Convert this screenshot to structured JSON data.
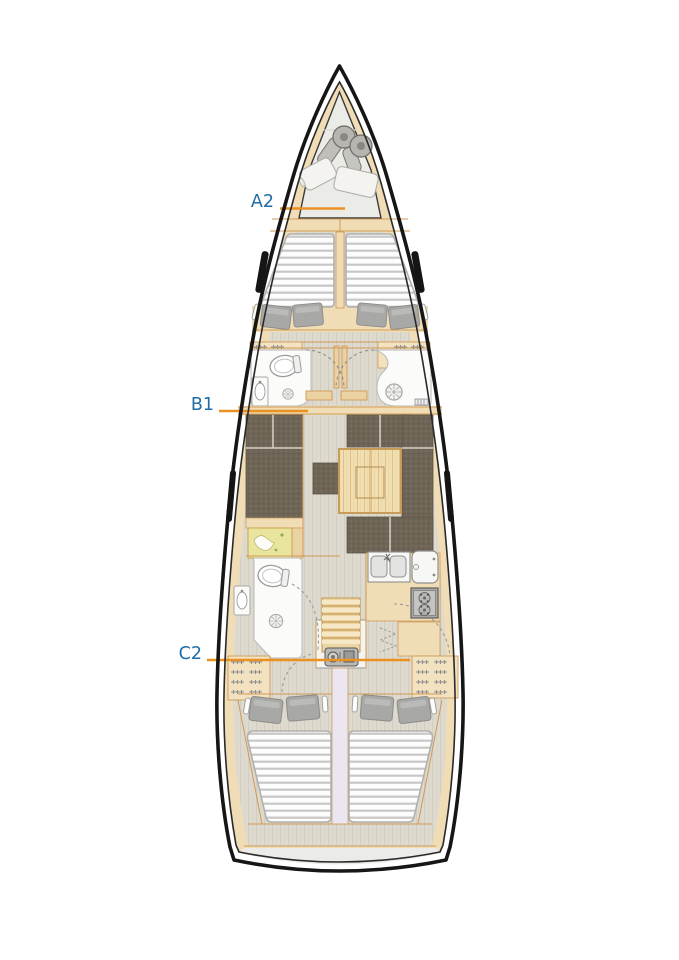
{
  "page": {
    "background": "#ffffff"
  },
  "diagram": {
    "title": "sailing-yacht-interior-layout-top-view",
    "labels": [
      {
        "text": "A2",
        "target": "forward-cabin"
      },
      {
        "text": "B1",
        "target": "saloon"
      },
      {
        "text": "C2",
        "target": "aft-cabins"
      }
    ],
    "colors": {
      "label_text": "#1e6da7",
      "leader_line": "#ea9122",
      "hull_outline": "#1b1b1b",
      "deck_wood": "#f0ddb6",
      "trim": "#cf9a58",
      "floor": "#dedacf",
      "upholstery": "#6f6557",
      "mattress": "#fdfdfd",
      "mattress_stripe": "#c7c7c7",
      "fixture_white": "#fbfbfa",
      "chart_map": "#e9e59f",
      "locker_gray": "#ebebe8"
    },
    "symbols": [
      "anchor-locker",
      "fenders",
      "v-berth",
      "pillows",
      "reading-lights",
      "shelf-lockers",
      "toilet",
      "washbasin",
      "shower-drain",
      "door-swing",
      "sofa-l-shaped",
      "sofa-u-shaped",
      "saloon-table",
      "stool",
      "chart-table",
      "galley-double-sink",
      "refrigerator",
      "stove-two-burner",
      "companionway-steps",
      "engine",
      "hanging-lockers",
      "double-berth",
      "hull-window",
      "transom"
    ]
  }
}
